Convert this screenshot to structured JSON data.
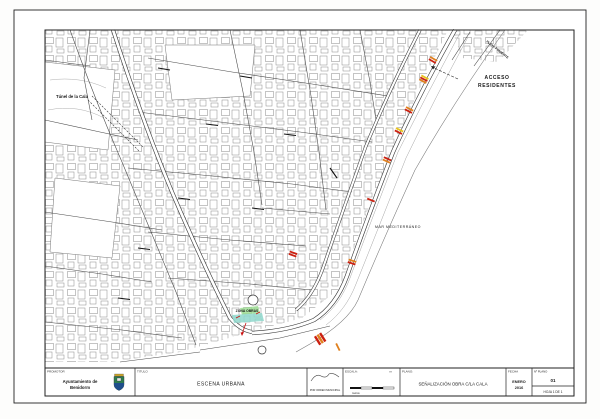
{
  "sheet": {
    "map_labels": {
      "tunnel": "Túnel de la Cala",
      "sea": "MAR MEDITERRÁNEO",
      "access_line1": "ACCESO",
      "access_line2": "RESIDENTES",
      "coast_road": "PLAYA PONIENTE",
      "work_zone": "ZONA OBRAS"
    },
    "colors": {
      "marker_red": "#cc2010",
      "marker_orange": "#e0801e",
      "marker_yellow": "#e8c31e",
      "highlight_cyan": "#8fd8cc",
      "highlight_green": "#98dd8e",
      "shield_green": "#2e7d4f",
      "shield_blue": "#1f4e8c"
    },
    "titleblock": {
      "promotor_label": "PROMOTOR",
      "org_line1": "Ayuntamiento de",
      "org_line2": "Benidorm",
      "titulo_label": "TITULO",
      "titulo_value": "ESCENA URBANA",
      "firma_caption": "POR ORDEN MUNICIPAL",
      "escala_label": "ESCALA:",
      "escala_unit": "m",
      "escala_sub": "metros",
      "plano_label": "PLANO:",
      "plano_value": "SEÑALIZACIÓN OBRA C/LA CALA",
      "fecha_label": "FECHA",
      "fecha_line1": "ENERO",
      "fecha_line2": "2016",
      "num_plano_label": "Nº PLANO",
      "num_plano_value": "01",
      "hoja_value": "HOJA 1 DE 1"
    }
  }
}
